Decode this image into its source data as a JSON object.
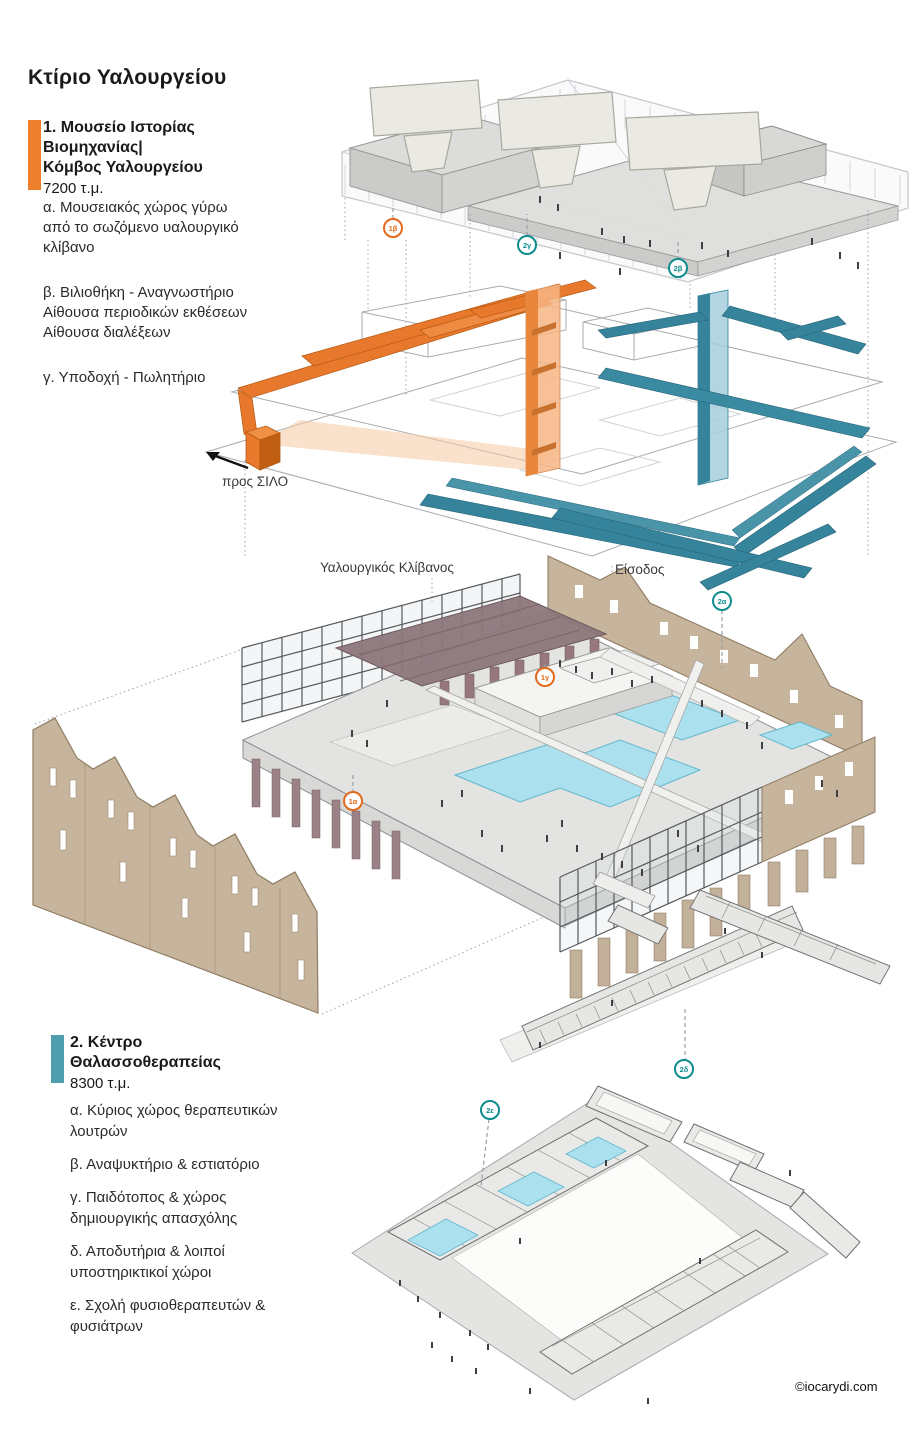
{
  "page": {
    "title": "Κτίριο Υαλουργείου",
    "copyright": "©iocarydi.com"
  },
  "colors": {
    "accent_orange": "#EE7F2D",
    "accent_teal": "#4E9DAD",
    "ramp_orange": "#E8792C",
    "ramp_teal": "#35849B",
    "badge_orange": "#E2691B",
    "badge_teal": "#0E8C8E",
    "pool_cyan": "#ABE0EE",
    "furnace_mauve": "#9B8286",
    "brick_tan": "#C6B49D"
  },
  "legend1": {
    "title_lines": [
      "1. Μουσείο Ιστορίας",
      "Βιομηχανίας|",
      "Κόμβος Υαλουργείου"
    ],
    "area": "7200 τ.μ.",
    "items": [
      {
        "lines": [
          "α. Μουσειακός χώρος γύρω",
          "από το σωζόμενο υαλουργικό",
          "κλίβανο"
        ]
      },
      {
        "lines": [
          "β. Βιλιοθήκη - Αναγνωστήριο",
          "Αίθουσα περιοδικών εκθέσεων",
          "Αίθουσα διαλέξεων"
        ]
      },
      {
        "lines": [
          "γ. Υποδοχή - Πωλητήριο"
        ]
      }
    ]
  },
  "legend2": {
    "title_lines": [
      "2. Κέντρο",
      "Θαλασσοθεραπείας"
    ],
    "area": "8300 τ.μ.",
    "items": [
      {
        "lines": [
          "α. Κύριος χώρος θεραπευτικών",
          "λουτρών"
        ]
      },
      {
        "lines": [
          "β. Αναψυκτήριο & εστιατόριο"
        ]
      },
      {
        "lines": [
          "γ. Παιδότοπος & χώρος",
          "δημιουργικής απασχόλης"
        ]
      },
      {
        "lines": [
          "δ. Αποδυτήρια & λοιποί",
          "υποστηρικτικοί χώροι"
        ]
      },
      {
        "lines": [
          "ε. Σχολή φυσιοθεραπευτών &",
          "φυσιάτρων"
        ]
      }
    ]
  },
  "diagram_labels": {
    "to_silo": "προς ΣΙΛΟ",
    "furnace": "Υαλουργικός Κλίβανος",
    "entrance": "Είσοδος"
  },
  "badges": [
    {
      "id": "1β",
      "color": "orange"
    },
    {
      "id": "2γ",
      "color": "teal"
    },
    {
      "id": "2β",
      "color": "teal"
    },
    {
      "id": "2α",
      "color": "teal"
    },
    {
      "id": "1γ",
      "color": "orange"
    },
    {
      "id": "1α",
      "color": "orange"
    },
    {
      "id": "2δ",
      "color": "teal"
    },
    {
      "id": "2ε",
      "color": "teal"
    }
  ]
}
